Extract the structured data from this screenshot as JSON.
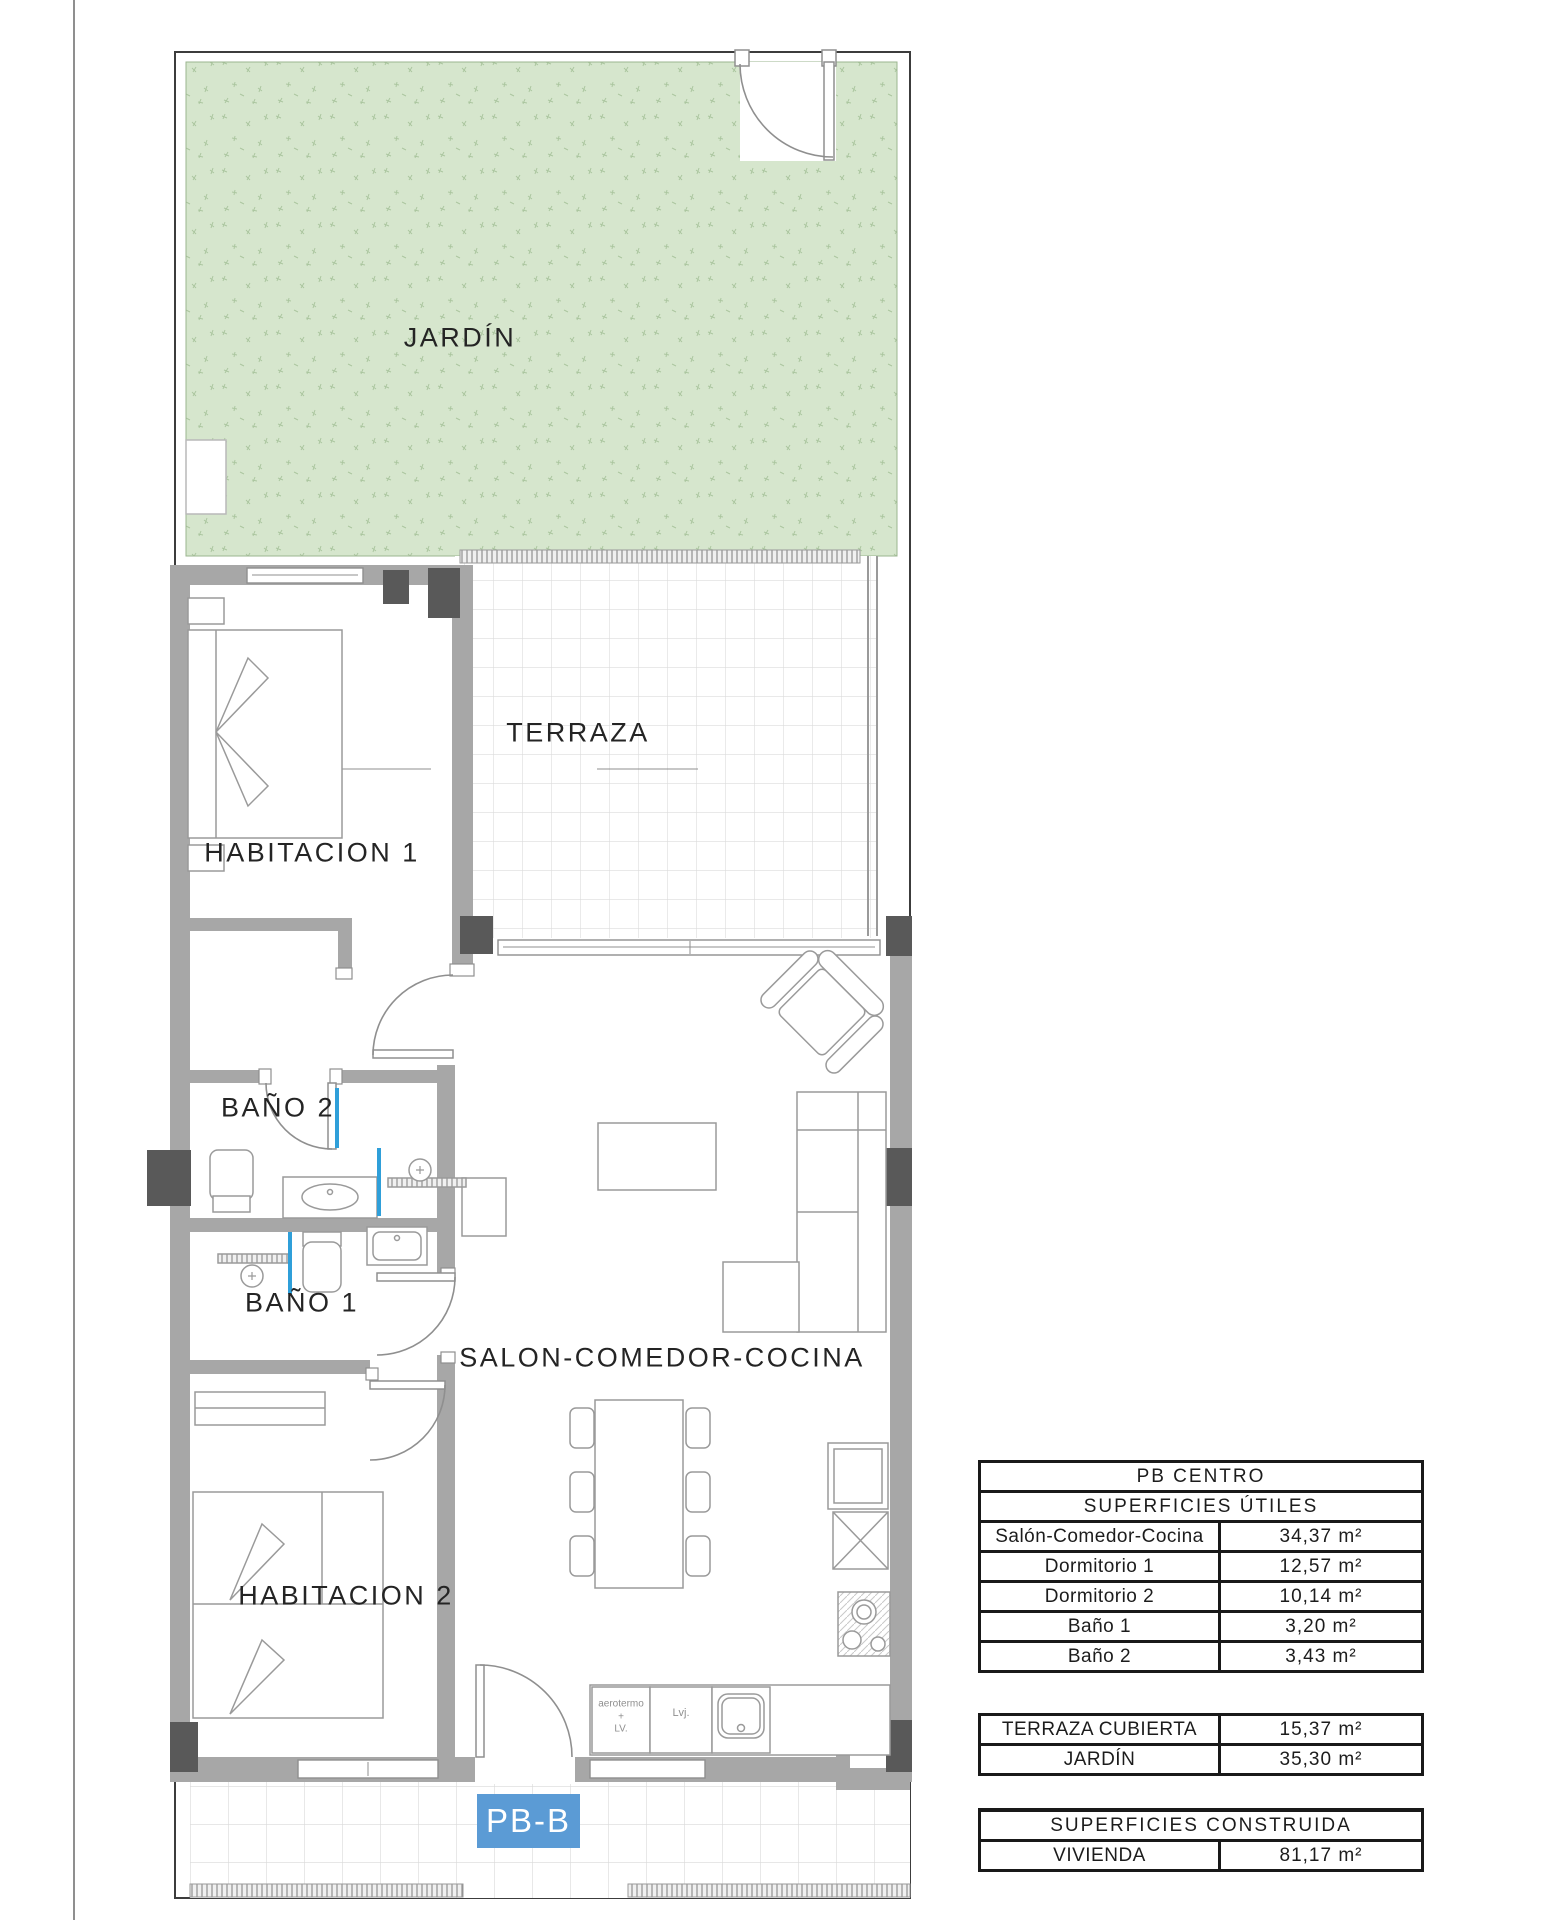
{
  "plan": {
    "labels": {
      "garden": "JARDÍN",
      "terrace": "TERRAZA",
      "bedroom1": "HABITACION 1",
      "bath2": "BAÑO 2",
      "bath1": "BAÑO 1",
      "living": "SALON-COMEDOR-COCINA",
      "bedroom2": "HABITACION 2"
    },
    "unit_badge": "PB-B",
    "kitchen": {
      "aerotermo": "aerotermo\n+\nLV.",
      "dishwasher": "Lvj."
    }
  },
  "tables": {
    "useful": {
      "title": "PB CENTRO",
      "subtitle": "SUPERFICIES ÚTILES",
      "rows": [
        {
          "label": "Salón-Comedor-Cocina",
          "value": "34,37 m²"
        },
        {
          "label": "Dormitorio 1",
          "value": "12,57 m²"
        },
        {
          "label": "Dormitorio 2",
          "value": "10,14 m²"
        },
        {
          "label": "Baño 1",
          "value": "3,20 m²"
        },
        {
          "label": "Baño 2",
          "value": "3,43 m²"
        }
      ]
    },
    "exterior": {
      "rows": [
        {
          "label": "TERRAZA CUBIERTA",
          "value": "15,37 m²"
        },
        {
          "label": "JARDÍN",
          "value": "35,30 m²"
        }
      ]
    },
    "built": {
      "title": "SUPERFICIES CONSTRUIDA",
      "rows": [
        {
          "label": "VIVIENDA",
          "value": "81,17 m²"
        }
      ]
    }
  },
  "colors": {
    "garden": "#d6e6cd",
    "wall": "#a7a7a7",
    "pillar": "#595959",
    "badge_bg": "#5b9bd5",
    "glass_screen": "#2f9fd9"
  }
}
